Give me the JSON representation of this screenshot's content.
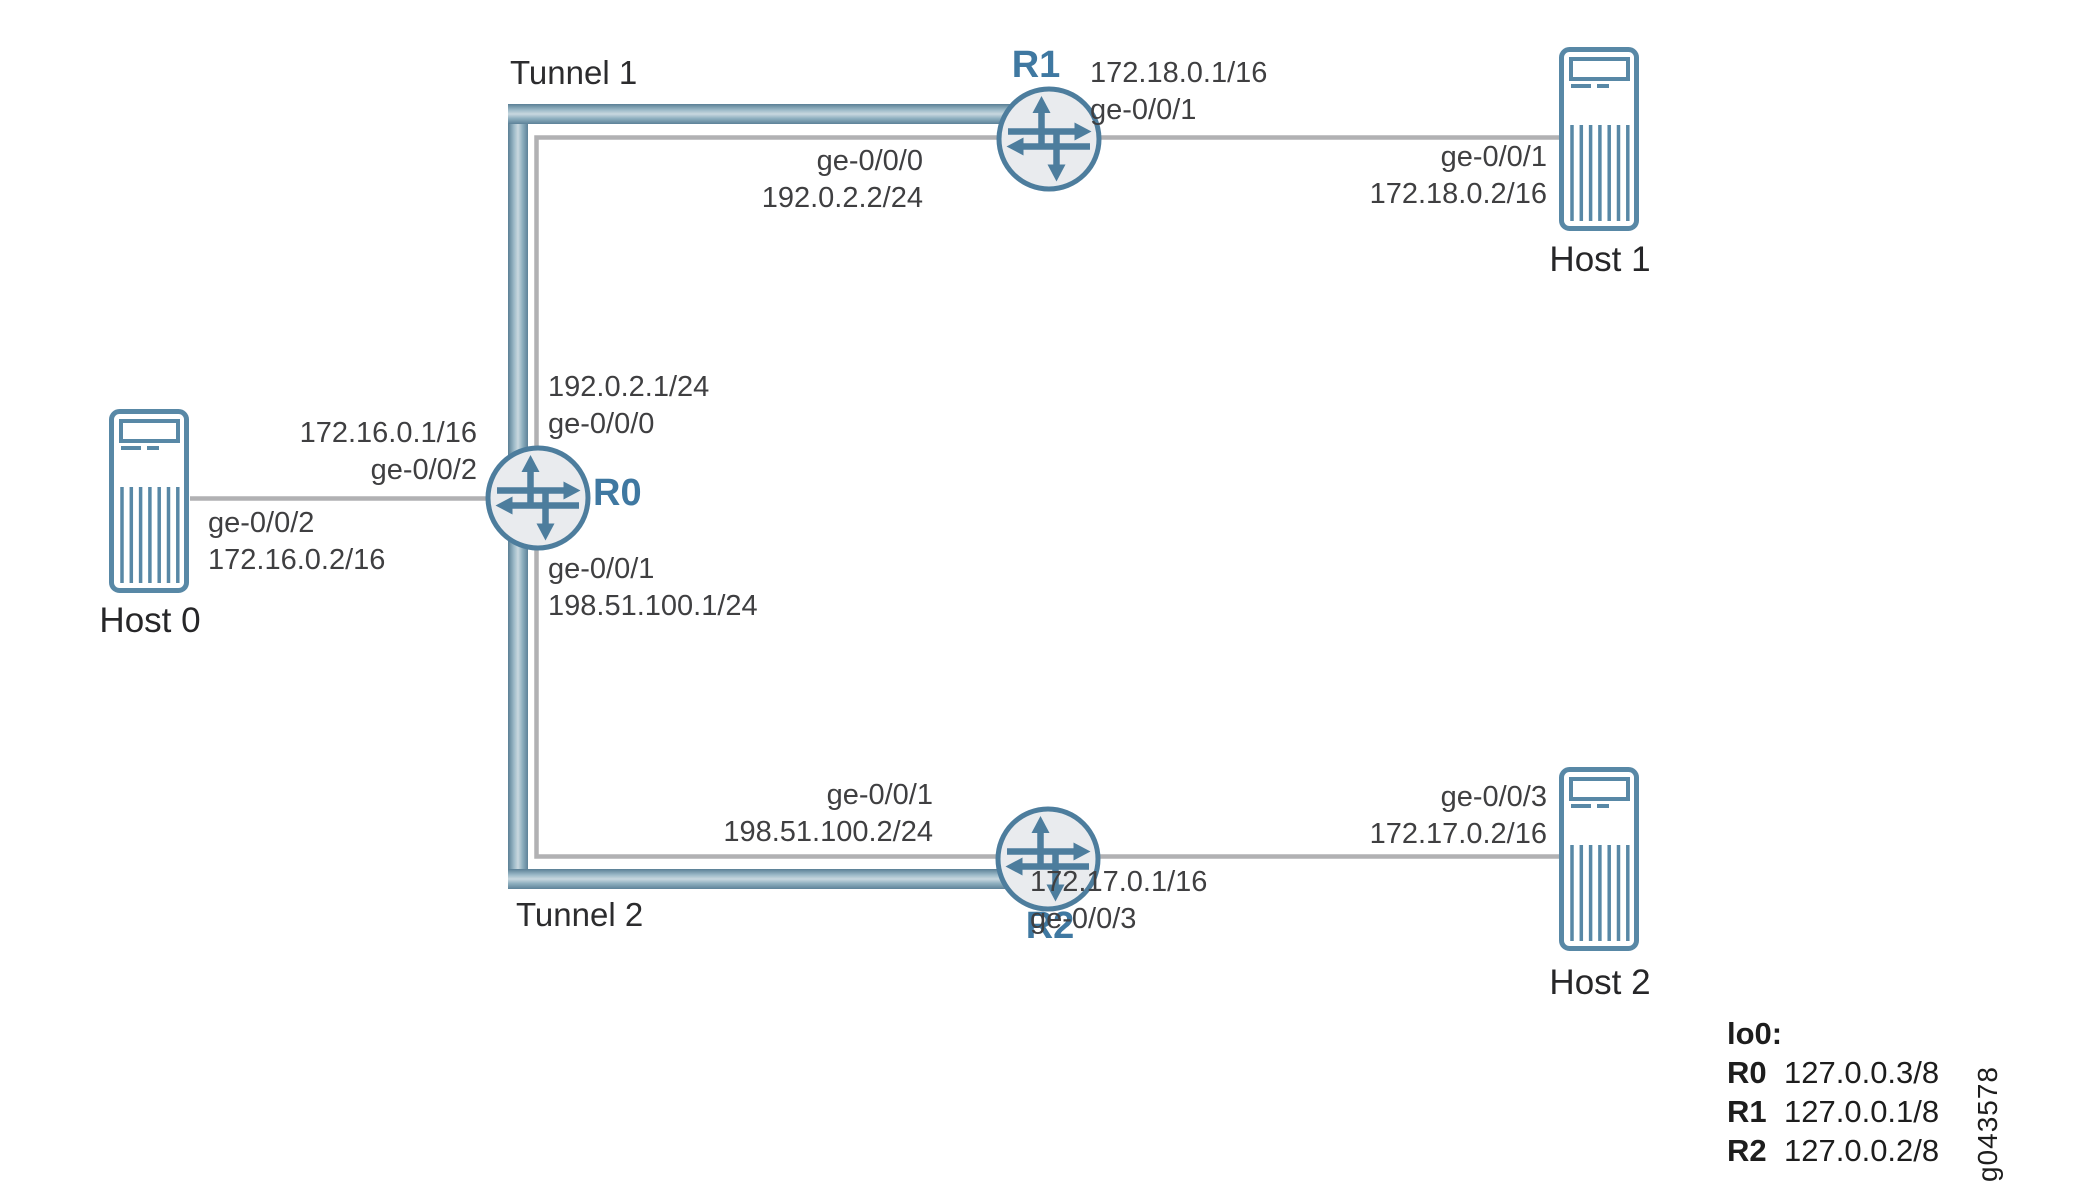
{
  "tunnels": [
    {
      "label": "Tunnel 1"
    },
    {
      "label": "Tunnel 2"
    }
  ],
  "routers": [
    {
      "name": "R0"
    },
    {
      "name": "R1"
    },
    {
      "name": "R2"
    }
  ],
  "hosts": [
    {
      "name": "Host 0"
    },
    {
      "name": "Host 1"
    },
    {
      "name": "Host 2"
    }
  ],
  "interface_labels": {
    "r0_to_r1": {
      "line1": "192.0.2.1/24",
      "line2": "ge-0/0/0"
    },
    "r0_to_host0": {
      "line1": "172.16.0.1/16",
      "line2": "ge-0/0/2"
    },
    "r0_to_r2": {
      "line1": "ge-0/0/1",
      "line2": "198.51.100.1/24"
    },
    "host0_to_r0": {
      "line1": "ge-0/0/2",
      "line2": "172.16.0.2/16"
    },
    "r1_to_r0": {
      "line1": "ge-0/0/0",
      "line2": "192.0.2.2/24"
    },
    "r1_to_host1": {
      "line1": "172.18.0.1/16",
      "line2": "ge-0/0/1"
    },
    "host1_to_r1": {
      "line1": "ge-0/0/1",
      "line2": "172.18.0.2/16"
    },
    "r2_to_r0": {
      "line1": "ge-0/0/1",
      "line2": "198.51.100.2/24"
    },
    "r2_to_host2": {
      "line1": "172.17.0.1/16",
      "line2": "ge-0/0/3"
    },
    "host2_to_r2": {
      "line1": "ge-0/0/3",
      "line2": "172.17.0.2/16"
    }
  },
  "legend": {
    "title": "lo0:",
    "rows": [
      {
        "name": "R0",
        "value": "127.0.0.3/8"
      },
      {
        "name": "R1",
        "value": "127.0.0.1/8"
      },
      {
        "name": "R2",
        "value": "127.0.0.2/8"
      }
    ]
  },
  "figure_id": "g043578",
  "colors": {
    "steel_blue_stroke": "#4d7d9d",
    "router_fill": "#e9ebee",
    "router_label_blue": "#3f78a1",
    "link_gray": "#b1b1b3",
    "tunnel_band_dark": "#5a8096",
    "tunnel_band_light": "#c9d8df",
    "label_text": "#3f3f41"
  }
}
